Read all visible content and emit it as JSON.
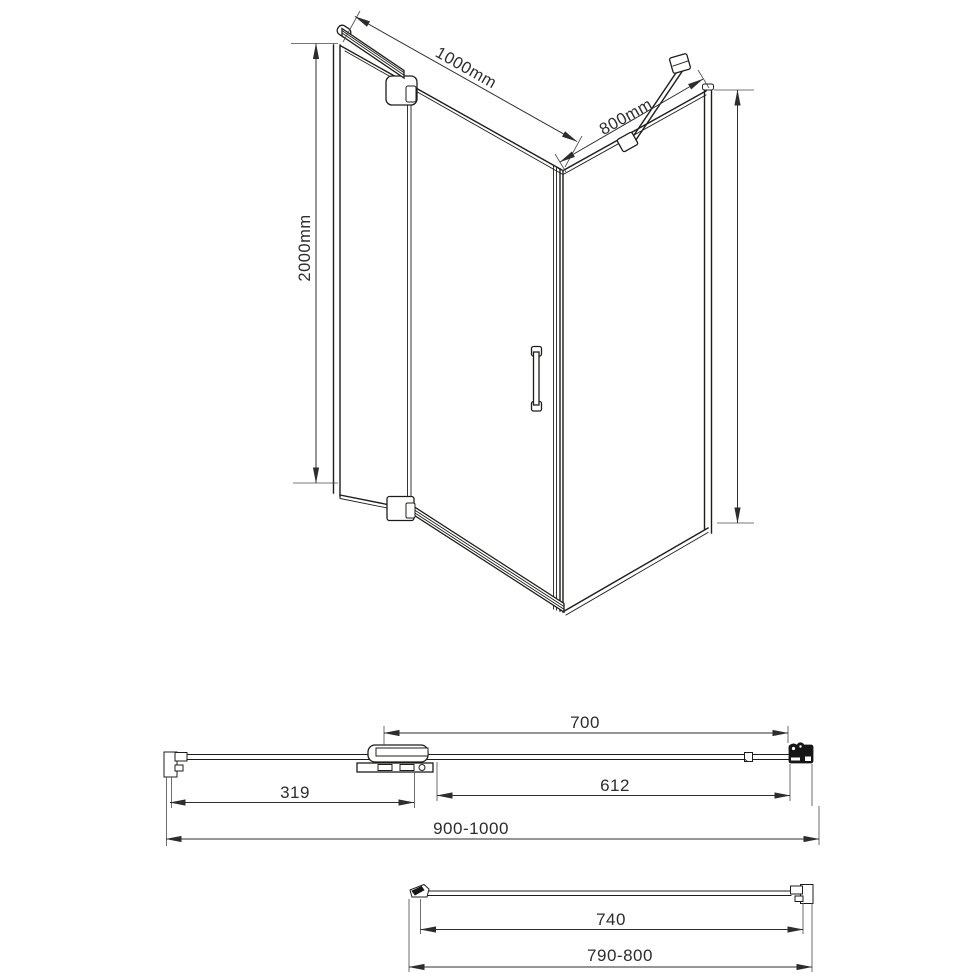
{
  "page": {
    "background": "#ffffff",
    "line_color": "#1d1d1b"
  },
  "iso_view": {
    "width_dim": "1000mm",
    "depth_dim": "800mm",
    "height_dim": "2000mm"
  },
  "door_plan_view": {
    "hinge_to_wall_dim": "700",
    "fixed_glass_dim": "319",
    "door_glass_dim": "612",
    "overall_width_dim": "900-1000"
  },
  "side_plan_view": {
    "glass_width_dim": "740",
    "overall_width_dim": "790-800"
  }
}
